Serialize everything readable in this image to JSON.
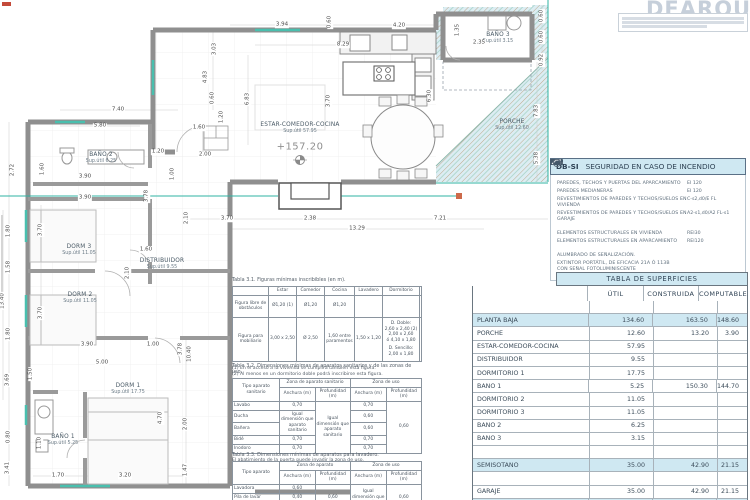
{
  "titleblock": {
    "logo": "DEARQUITEC"
  },
  "plan": {
    "level": "+157.20",
    "rooms": [
      {
        "name": "ESTAR-COMEDOR-COCINA",
        "sup": "Sup.útil 57.95",
        "x": 300,
        "y": 122
      },
      {
        "name": "BAÑO 2",
        "sup": "Sup.útil 6.25",
        "x": 101,
        "y": 152
      },
      {
        "name": "DORM 3",
        "sup": "Sup.útil 11.05",
        "x": 79,
        "y": 244
      },
      {
        "name": "DISTRIBUIDOR",
        "sup": "Sup.útil 9.55",
        "x": 162,
        "y": 258
      },
      {
        "name": "DORM 2",
        "sup": "Sup.útil 11.05",
        "x": 80,
        "y": 292
      },
      {
        "name": "DORM 1",
        "sup": "Sup.útil 17.75",
        "x": 128,
        "y": 383
      },
      {
        "name": "BAÑO 1",
        "sup": "Sup.útil 5.25",
        "x": 63,
        "y": 434
      },
      {
        "name": "BAÑO 3",
        "sup": "Sup.útil 3.15",
        "x": 498,
        "y": 32
      },
      {
        "name": "PORCHE",
        "sup": "Sup.útil 12.60",
        "x": 512,
        "y": 119
      }
    ],
    "dims": [
      {
        "t": "3.94",
        "x": 282,
        "y": 25
      },
      {
        "t": "0.60",
        "x": 330,
        "y": 22,
        "r": 1
      },
      {
        "t": "4.20",
        "x": 399,
        "y": 26
      },
      {
        "t": "8.29",
        "x": 343,
        "y": 45
      },
      {
        "t": "3.03",
        "x": 215,
        "y": 49,
        "r": 1
      },
      {
        "t": "4.83",
        "x": 206,
        "y": 77,
        "r": 1
      },
      {
        "t": "0.60",
        "x": 213,
        "y": 98,
        "r": 1
      },
      {
        "t": "6.83",
        "x": 248,
        "y": 99,
        "r": 1
      },
      {
        "t": "3.70",
        "x": 329,
        "y": 101,
        "r": 1
      },
      {
        "t": "6.30",
        "x": 430,
        "y": 96,
        "r": 1
      },
      {
        "t": "1.35",
        "x": 458,
        "y": 30,
        "r": 1
      },
      {
        "t": "2.35",
        "x": 479,
        "y": 43
      },
      {
        "t": "0.60",
        "x": 542,
        "y": 16,
        "r": 1
      },
      {
        "t": "0.60",
        "x": 542,
        "y": 37,
        "r": 1
      },
      {
        "t": "0.92",
        "x": 542,
        "y": 60,
        "r": 1
      },
      {
        "t": "7.83",
        "x": 537,
        "y": 111,
        "r": 1
      },
      {
        "t": "5.38",
        "x": 537,
        "y": 158,
        "r": 1
      },
      {
        "t": "7.40",
        "x": 118,
        "y": 110
      },
      {
        "t": "5.80",
        "x": 100,
        "y": 126
      },
      {
        "t": "1.20",
        "x": 222,
        "y": 117,
        "r": 1
      },
      {
        "t": "1.60",
        "x": 199,
        "y": 128
      },
      {
        "t": "2.72",
        "x": 13,
        "y": 170,
        "r": 1
      },
      {
        "t": "1.60",
        "x": 43,
        "y": 169,
        "r": 1
      },
      {
        "t": "1.20",
        "x": 158,
        "y": 152
      },
      {
        "t": "2.00",
        "x": 205,
        "y": 155
      },
      {
        "t": "1.00",
        "x": 173,
        "y": 174,
        "r": 1
      },
      {
        "t": "3.90",
        "x": 85,
        "y": 177
      },
      {
        "t": "3.90",
        "x": 85,
        "y": 198
      },
      {
        "t": "3.78",
        "x": 147,
        "y": 196,
        "r": 1
      },
      {
        "t": "1.80",
        "x": 9,
        "y": 231,
        "r": 1
      },
      {
        "t": "3.70",
        "x": 41,
        "y": 230,
        "r": 1
      },
      {
        "t": "1.58",
        "x": 9,
        "y": 267,
        "r": 1
      },
      {
        "t": "13.40",
        "x": 3,
        "y": 301,
        "r": 1
      },
      {
        "t": "1.80",
        "x": 9,
        "y": 334,
        "r": 1
      },
      {
        "t": "1.60",
        "x": 146,
        "y": 250
      },
      {
        "t": "2.10",
        "x": 128,
        "y": 273,
        "r": 1
      },
      {
        "t": "3.70",
        "x": 41,
        "y": 313,
        "r": 1
      },
      {
        "t": "3.69",
        "x": 8,
        "y": 380,
        "r": 1
      },
      {
        "t": "0.80",
        "x": 9,
        "y": 437,
        "r": 1
      },
      {
        "t": "3.41",
        "x": 8,
        "y": 468,
        "r": 1
      },
      {
        "t": "3.90",
        "x": 87,
        "y": 345
      },
      {
        "t": "1.00",
        "x": 153,
        "y": 345
      },
      {
        "t": "3.78",
        "x": 181,
        "y": 349,
        "r": 1
      },
      {
        "t": "10.40",
        "x": 190,
        "y": 354,
        "r": 1
      },
      {
        "t": "5.00",
        "x": 102,
        "y": 363
      },
      {
        "t": "1.50",
        "x": 31,
        "y": 374,
        "r": 1
      },
      {
        "t": "4.70",
        "x": 161,
        "y": 418,
        "r": 1
      },
      {
        "t": "2.00",
        "x": 186,
        "y": 424,
        "r": 1
      },
      {
        "t": "1.10",
        "x": 40,
        "y": 443,
        "r": 1
      },
      {
        "t": "1.70",
        "x": 58,
        "y": 476
      },
      {
        "t": "3.20",
        "x": 125,
        "y": 476
      },
      {
        "t": "1.47",
        "x": 186,
        "y": 470,
        "r": 1
      },
      {
        "t": "2.10",
        "x": 187,
        "y": 218,
        "r": 1
      },
      {
        "t": "3.70",
        "x": 227,
        "y": 219
      },
      {
        "t": "2.38",
        "x": 310,
        "y": 219
      },
      {
        "t": "7.21",
        "x": 440,
        "y": 219
      },
      {
        "t": "13.29",
        "x": 357,
        "y": 229
      }
    ]
  },
  "dbsi": {
    "code": "DB-SI",
    "title": "SEGURIDAD EN CASO DE INCENDIO",
    "rows": [
      {
        "l1": "PAREDES, TECHOS Y PUERTAS DEL APARCAMIENTO",
        "v": "EI 120"
      },
      {
        "l1": "PAREDES MEDIANERAS",
        "v": "EI 120"
      },
      {
        "l1": "REVESTIMIENTOS DE PAREDES Y TECHOS/SUELOS EN VIVIENDA",
        "v": "C-s2,d0/E FL"
      },
      {
        "l1": "REVESTIMIENTOS DE PAREDES Y TECHOS/SUELOS EN GARAJE",
        "v": "A2-s1,d0/A2 FL-s1"
      },
      {
        "l1": "ELEMENTOS ESTRUCTURALES EN VIVIENDA",
        "v": "REI30",
        "cls": "gap"
      },
      {
        "l1": "ELEMENTOS ESTRUCTURALES EN APARCAMIENTO",
        "v": "REI120"
      }
    ],
    "alumbrado": "ALUMBRADO DE SEÑALIZACIÓN.",
    "extintor_l1": "EXTINTOR PORTÁTIL, DE EFICACIA 21A Ó 113B",
    "extintor_l2": "CON SEÑAL FOTOLUMINISCENTE"
  },
  "superficies": {
    "title": "TABLA DE SUPERFICIES",
    "cols": [
      "ÚTIL",
      "CONSTRUIDA",
      "COMPUTABLE"
    ],
    "rows": [
      {
        "cls": "sp"
      },
      {
        "label": "PLANTA  BAJA",
        "util": "134.60",
        "cons": "163.50",
        "comp": "148.60",
        "cls": "hl"
      },
      {
        "label": "PORCHE",
        "util": "12.60",
        "cons": "13.20",
        "comp": "3.90"
      },
      {
        "label": "ESTAR-COMEDOR-COCINA",
        "util": "57.95"
      },
      {
        "label": "DISTRIBUIDOR",
        "util": "9.55"
      },
      {
        "label": "DORMITORIO 1",
        "util": "17.75"
      },
      {
        "label": "BAÑO 1",
        "util": "5.25",
        "cons": "150.30",
        "comp": "144.70"
      },
      {
        "label": "DORMITORIO 2",
        "util": "11.05"
      },
      {
        "label": "DORMITORIO 3",
        "util": "11.05"
      },
      {
        "label": "BAÑO 2",
        "util": "6.25"
      },
      {
        "label": "BAÑO 3",
        "util": "3.15"
      },
      {
        "cls": "sp"
      },
      {
        "label": "SEMISÓTANO",
        "util": "35.00",
        "cons": "42.90",
        "comp": "21.15",
        "cls": "hl"
      },
      {
        "cls": "sp"
      },
      {
        "label": "GARAJE",
        "util": "35.00",
        "cons": "42.90",
        "comp": "21.15"
      },
      {
        "label": "TOTAL",
        "util": "169.60",
        "cons": "206.40",
        "comp": "169.75",
        "cls": "hl"
      }
    ]
  },
  "t31": {
    "title": "Tabla 3.1. Figuras mínimas inscribibles (en m).",
    "cols": [
      "Estar",
      "Comedor",
      "Cocina",
      "Lavadero",
      "Dormitorio",
      "Baño"
    ],
    "row1_label": "Figura libre de obstáculos",
    "row1": [
      "Ø1,20 (1)",
      "Ø1,20",
      "Ø1,20",
      "",
      "",
      "Ø1,20 (3)"
    ],
    "row2_label": "Figura para mobiliario",
    "row2_estar": "3,00 x 2,50",
    "row2_comedor": "Ø 2,50",
    "row2_cocina": "1,60 entre paramentos",
    "row2_lavadero": "1,50 x 1,20",
    "row2_dorm_a": "D. Doble:",
    "row2_dorm_b": "2,60 x 2,40 (2)",
    "row2_dorm_c": "2,00 x 2,60",
    "row2_dorm_d": "ó 4,10 x 1,80",
    "row2_dorm_e": "D. Sencillo:",
    "row2_dorm_f": "2,00 x 1,80",
    "note1": "(1) En el acceso a la vivienda se cumplirá también esta figura.",
    "note2": "(2) Al menos en un dormitorio doble podrá inscribirse esta figura."
  },
  "t32": {
    "title": "Tabla 3.2. Dimensiones mínimas de aparatos sanitarios y de las zonas de uso.",
    "col_tipo": "Tipo aparato sanitario",
    "grp1": "Zona de aparato sanitario",
    "grp2": "Zona de uso",
    "anchura": "Anchura (m)",
    "profundidad": "Profundidad (m)",
    "lavabo": "Lavabo",
    "lavabo_a": "0,70",
    "lavabo_ua": "0,70",
    "ducha": "Ducha",
    "ducha_ua": "0,60",
    "banera": "Bañera",
    "banera_ua": "0,60",
    "bide": "Bidé",
    "bide_a": "0,70",
    "bide_ua": "0,70",
    "inodoro": "Inodoro",
    "inodoro_a": "0,70",
    "inodoro_ua": "0,70",
    "merged_a": "Igual dimensión que aparato sanitario",
    "merged_p": "Igual dimensión que aparato sanitario",
    "merged_up": "0,60",
    "note": "El abatimiento de la puerta puede invadir la zona de uso."
  },
  "t33": {
    "title": "Tabla 3.3. Dimensiones mínimas de aparatos para lavadero.",
    "col_tipo": "Tipo aparato",
    "grp1": "Zona de aparato",
    "grp2": "Zona de uso",
    "anchura": "Anchura (m)",
    "profundidad": "Profundidad (m)",
    "lavadora": "Lavadora",
    "lavadora_a": "0,60",
    "pila": "Pila de lavar",
    "pila_a": "0,40",
    "secadora": "Secadora",
    "secadora_a": "0,60 (1)",
    "merged_p": "0,60",
    "merged_ua": "Igual dimensión que aparato",
    "merged_up": "0,60"
  }
}
